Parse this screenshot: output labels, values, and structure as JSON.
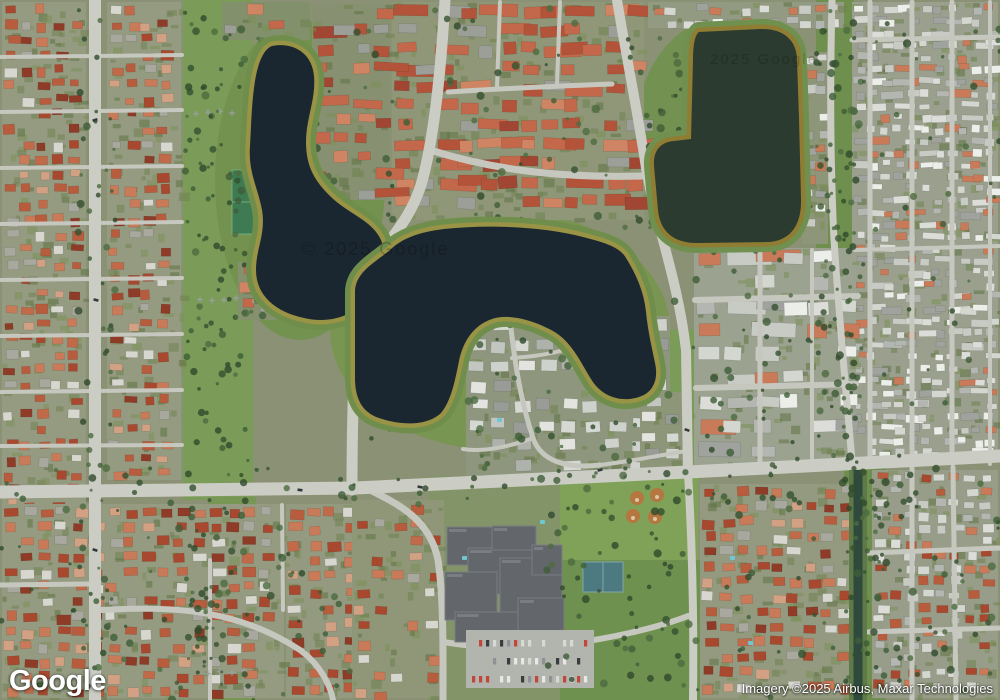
{
  "branding": {
    "logo": "Google"
  },
  "attribution": {
    "text": "Imagery ©2025 Airbus, Maxar Technologies"
  },
  "watermarks": [
    {
      "text": "© 2025 Google",
      "x": 302,
      "y": 255,
      "size": 18,
      "opacity": 0.22
    },
    {
      "text": "2025 Google",
      "x": 710,
      "y": 64,
      "size": 15,
      "opacity": 0.18
    }
  ],
  "map": {
    "colors": {
      "base": "#8b9174",
      "road_major": "#cbccc4",
      "road_minor": "#c6c8bf",
      "lawn": [
        "#6f8250",
        "#7b8f58",
        "#5e7344"
      ],
      "tree": [
        "#3f5e38",
        "#4c6c40",
        "#35512f",
        "#2f4a2c"
      ],
      "car": [
        "#e8e8e6",
        "#3a3d40",
        "#8f9294",
        "#c2473a",
        "#d8d8d4"
      ]
    },
    "palettes": {
      "redMix": [
        "#a8492f",
        "#b85c3e",
        "#c97a58",
        "#8e3b28",
        "#c06a4a",
        "#d8d7cf",
        "#a8a89f",
        "#b85c3e",
        "#a8492f",
        "#c97a58",
        "#d2a184"
      ],
      "condoRed": [
        "#b3543a",
        "#c3684a",
        "#a04632",
        "#cf8563",
        "#b3543a",
        "#c3684a",
        "#9c9f98"
      ],
      "whiteMix": [
        "#dcddd8",
        "#c8cac4",
        "#eceeea",
        "#b4b7b1",
        "#d4d6d0",
        "#9fa29d",
        "#c97a58"
      ],
      "grayTown": [
        "#c2c5c0",
        "#d6d8d3",
        "#aeb1ac",
        "#e3e4e0",
        "#989b96",
        "#cfd1cc"
      ],
      "mixed": [
        "#dcddd8",
        "#b85c3e",
        "#c8cac4",
        "#a8492f",
        "#d4d6d0",
        "#c97a58",
        "#b4b7b1"
      ]
    },
    "green_zones": [
      {
        "type": "rect",
        "x": 183,
        "y": 0,
        "w": 70,
        "h": 500,
        "fill": "#7b9b58"
      },
      {
        "type": "rect",
        "x": 208,
        "y": 497,
        "w": 48,
        "h": 203,
        "fill": "#789755"
      },
      {
        "type": "ellipse",
        "cx": 300,
        "cy": 180,
        "rx": 85,
        "ry": 160,
        "fill": "#74924f"
      },
      {
        "type": "ellipse",
        "cx": 500,
        "cy": 330,
        "rx": 170,
        "ry": 120,
        "fill": "#789551"
      },
      {
        "type": "ellipse",
        "cx": 730,
        "cy": 135,
        "rx": 95,
        "ry": 120,
        "fill": "#739150"
      },
      {
        "type": "rect",
        "x": 640,
        "y": 330,
        "w": 60,
        "h": 150,
        "fill": "#7b9b58"
      },
      {
        "type": "rect",
        "x": 816,
        "y": 0,
        "w": 38,
        "h": 468,
        "fill": "#6f8f4e"
      },
      {
        "type": "rect",
        "x": 844,
        "y": 468,
        "w": 42,
        "h": 232,
        "fill": "#6f8f4e"
      },
      {
        "type": "rect",
        "x": 540,
        "y": 474,
        "w": 158,
        "h": 110,
        "fill": "#7fa258"
      },
      {
        "type": "rect",
        "x": 560,
        "y": 560,
        "w": 140,
        "h": 140,
        "fill": "#6f9150"
      },
      {
        "type": "rect",
        "x": 428,
        "y": 476,
        "w": 132,
        "h": 224,
        "fill": "#839468"
      },
      {
        "type": "rect",
        "x": 91,
        "y": 8,
        "w": 4,
        "h": 80,
        "fill": "#688a47"
      },
      {
        "type": "rect",
        "x": 91,
        "y": 128,
        "w": 4,
        "h": 170,
        "fill": "#688a47"
      },
      {
        "type": "rect",
        "x": 91,
        "y": 330,
        "w": 4,
        "h": 125,
        "fill": "#688a47"
      },
      {
        "type": "rect",
        "x": 93,
        "y": 525,
        "w": 4,
        "h": 175,
        "fill": "#688a47"
      }
    ],
    "regions": [
      {
        "name": "left-west",
        "x": 2,
        "y": 2,
        "w": 84,
        "h": 694,
        "sx": 16,
        "sy": 15,
        "hw": [
          8,
          13
        ],
        "hh": [
          6,
          10
        ],
        "skip": 0.22,
        "palette": "redMix",
        "ground": "#949b81"
      },
      {
        "name": "left-mid",
        "x": 107,
        "y": 2,
        "w": 74,
        "h": 478,
        "sx": 16,
        "sy": 15,
        "hw": [
          8,
          13
        ],
        "hh": [
          6,
          10
        ],
        "skip": 0.2,
        "palette": "redMix",
        "ground": "#949b81"
      },
      {
        "name": "top-center",
        "x": 392,
        "y": 2,
        "w": 252,
        "h": 218,
        "sx": 21,
        "sy": 19,
        "hw": [
          12,
          19
        ],
        "hh": [
          9,
          13
        ],
        "skip": 0.25,
        "palette": "condoRed",
        "ground": "#8f9778",
        "strip": true
      },
      {
        "name": "lakeA-east",
        "x": 312,
        "y": 4,
        "w": 78,
        "h": 196,
        "sx": 20,
        "sy": 18,
        "hw": [
          11,
          17
        ],
        "hh": [
          8,
          12
        ],
        "skip": 0.3,
        "palette": "condoRed",
        "ground": "#879070",
        "strip": true
      },
      {
        "name": "lakeA-top",
        "x": 222,
        "y": 2,
        "w": 88,
        "h": 38,
        "sx": 20,
        "sy": 17,
        "hw": [
          11,
          16
        ],
        "hh": [
          8,
          12
        ],
        "skip": 0.3,
        "palette": "condoRed",
        "ground": "#82906c"
      },
      {
        "name": "lakeA-south",
        "x": 238,
        "y": 262,
        "w": 118,
        "h": 58,
        "sx": 19,
        "sy": 17,
        "hw": [
          10,
          16
        ],
        "hh": [
          8,
          11
        ],
        "skip": 0.3,
        "palette": "condoRed",
        "ground": "#85916e",
        "strip": true
      },
      {
        "name": "right-top-grid",
        "x": 852,
        "y": 2,
        "w": 146,
        "h": 458,
        "sx": 13,
        "sy": 12,
        "hw": [
          7,
          11
        ],
        "hh": [
          5,
          8
        ],
        "skip": 0.2,
        "palette": "whiteMix",
        "ground": "#9aa08d",
        "strip": true
      },
      {
        "name": "lakeC-east-col",
        "x": 802,
        "y": 52,
        "w": 26,
        "h": 192,
        "sx": 12,
        "sy": 15,
        "hw": [
          8,
          11
        ],
        "hh": [
          6,
          9
        ],
        "skip": 0.25,
        "palette": "whiteMix",
        "ground": "#8d9678"
      },
      {
        "name": "lakeC-north",
        "x": 648,
        "y": 2,
        "w": 196,
        "h": 26,
        "sx": 15,
        "sy": 13,
        "hw": [
          8,
          12
        ],
        "hh": [
          6,
          9
        ],
        "skip": 0.25,
        "palette": "whiteMix",
        "ground": "#939a82"
      },
      {
        "name": "mid-right",
        "x": 694,
        "y": 248,
        "w": 162,
        "h": 218,
        "sx": 28,
        "sy": 24,
        "hw": [
          16,
          24
        ],
        "hh": [
          10,
          15
        ],
        "skip": 0.3,
        "palette": "whiteMix",
        "ground": "#9ba290",
        "strip": true
      },
      {
        "name": "peninsula",
        "x": 466,
        "y": 316,
        "w": 204,
        "h": 160,
        "sx": 23,
        "sy": 20,
        "hw": [
          13,
          18
        ],
        "hh": [
          9,
          12
        ],
        "skip": 0.25,
        "palette": "grayTown",
        "ground": "#8e977d"
      },
      {
        "name": "east-road-row",
        "x": 640,
        "y": 392,
        "w": 52,
        "h": 78,
        "sx": 20,
        "sy": 18,
        "hw": [
          11,
          15
        ],
        "hh": [
          8,
          11
        ],
        "skip": 0.3,
        "palette": "grayTown",
        "ground": "#8d9678"
      },
      {
        "name": "south-center",
        "x": 286,
        "y": 504,
        "w": 118,
        "h": 194,
        "sx": 18,
        "sy": 16,
        "hw": [
          9,
          14
        ],
        "hh": [
          7,
          10
        ],
        "skip": 0.25,
        "palette": "redMix",
        "ground": "#939a80"
      },
      {
        "name": "school-west",
        "x": 352,
        "y": 500,
        "w": 92,
        "h": 198,
        "sx": 18,
        "sy": 17,
        "hw": [
          9,
          13
        ],
        "hh": [
          7,
          10
        ],
        "skip": 0.45,
        "palette": "redMix",
        "ground": "#8f9778"
      },
      {
        "name": "bottom-left",
        "x": 2,
        "y": 504,
        "w": 282,
        "h": 194,
        "sx": 17,
        "sy": 15,
        "hw": [
          9,
          14
        ],
        "hh": [
          7,
          10
        ],
        "skip": 0.22,
        "palette": "redMix",
        "ground": "#949b81"
      },
      {
        "name": "se-west-canal",
        "x": 700,
        "y": 484,
        "w": 150,
        "h": 214,
        "sx": 17,
        "sy": 15,
        "hw": [
          9,
          14
        ],
        "hh": [
          7,
          10
        ],
        "skip": 0.22,
        "palette": "redMix",
        "ground": "#939a80"
      },
      {
        "name": "se-east-canal",
        "x": 872,
        "y": 470,
        "w": 126,
        "h": 228,
        "sx": 15,
        "sy": 13,
        "hw": [
          8,
          12
        ],
        "hh": [
          6,
          9
        ],
        "skip": 0.22,
        "palette": "mixed",
        "ground": "#979d88"
      }
    ],
    "roads_minor": [
      {
        "d": "M430,150 C500,172 570,178 642,176",
        "w": 7
      },
      {
        "d": "M368,292 C330,304 292,309 255,301",
        "w": 5
      },
      {
        "d": "M448,92 C510,88 560,86 612,84",
        "w": 5
      },
      {
        "d": "M500,2 L497,88",
        "w": 4
      },
      {
        "d": "M560,2 L557,85",
        "w": 4
      },
      {
        "d": "M0,57 L182,55",
        "w": 4
      },
      {
        "d": "M0,112 L182,110",
        "w": 4
      },
      {
        "d": "M0,168 L182,166",
        "w": 4
      },
      {
        "d": "M0,224 L182,222",
        "w": 4
      },
      {
        "d": "M0,280 L182,278",
        "w": 4
      },
      {
        "d": "M0,336 L182,334",
        "w": 4
      },
      {
        "d": "M0,392 L182,390",
        "w": 4
      },
      {
        "d": "M0,446 L182,445",
        "w": 4
      },
      {
        "d": "M870,2 L870,460",
        "w": 5
      },
      {
        "d": "M912,2 L912,462",
        "w": 5
      },
      {
        "d": "M952,2 L952,463",
        "w": 5
      },
      {
        "d": "M990,2 L990,464",
        "w": 4
      },
      {
        "d": "M852,40 L1000,37",
        "w": 5
      },
      {
        "d": "M855,250 L1000,246",
        "w": 4
      },
      {
        "d": "M912,468 L912,700",
        "w": 5
      },
      {
        "d": "M953,467 L956,700",
        "w": 5
      },
      {
        "d": "M868,553 L1000,548",
        "w": 5
      },
      {
        "d": "M866,632 L1000,628",
        "w": 5
      },
      {
        "d": "M695,300 L858,296",
        "w": 6
      },
      {
        "d": "M696,388 L856,384",
        "w": 6
      },
      {
        "d": "M760,250 L760,465",
        "w": 5
      },
      {
        "d": "M812,250 L812,462",
        "w": 4
      },
      {
        "d": "M510,320 C515,365 521,402 533,438 C541,461 566,469 600,465",
        "w": 5
      },
      {
        "d": "M533,438 C506,448 481,452 463,449",
        "w": 4
      },
      {
        "d": "M600,465 C634,461 660,455 687,451",
        "w": 4
      },
      {
        "d": "M512,358 C545,356 570,350 588,341",
        "w": 4
      },
      {
        "d": "M370,490 C400,505 430,520 438,560 C444,600 443,660 443,700",
        "w": 7
      },
      {
        "d": "M443,642 C480,648 520,650 560,645 C610,639 660,627 688,616",
        "w": 6
      },
      {
        "d": "M102,610 C180,605 242,612 300,650 C322,666 331,688 333,700",
        "w": 6
      },
      {
        "d": "M0,585 L88,584",
        "w": 5
      },
      {
        "d": "M210,560 L210,700",
        "w": 4
      },
      {
        "d": "M282,505 L283,610",
        "w": 4
      }
    ],
    "roads_major": [
      {
        "d": "M0,492 L355,488 L688,472 L1000,456",
        "w": 13
      },
      {
        "d": "M95,0 L95,700",
        "w": 12
      },
      {
        "d": "M445,0 C441,70 434,140 421,185 C405,235 372,250 361,295 C354,340 352,420 352,490",
        "w": 11
      },
      {
        "d": "M617,0 C627,60 639,120 646,168 C656,225 678,280 686,350 L688,473",
        "w": 10
      },
      {
        "d": "M688,473 C692,540 694,620 693,700",
        "w": 8
      },
      {
        "d": "M832,0 C830,80 830,160 834,240 C840,330 847,400 852,462",
        "w": 7
      }
    ],
    "road_cars": [
      [
        600,
        470
      ],
      [
        300,
        490
      ],
      [
        96,
        300
      ],
      [
        687,
        430
      ],
      [
        95,
        550
      ],
      [
        420,
        487
      ],
      [
        650,
        175
      ],
      [
        95,
        120
      ]
    ],
    "landmarks": {
      "school_buildings": [
        [
          447,
          527,
          58,
          38
        ],
        [
          468,
          548,
          72,
          46
        ],
        [
          445,
          572,
          52,
          48
        ],
        [
          500,
          558,
          62,
          56
        ],
        [
          455,
          612,
          72,
          30
        ],
        [
          518,
          598,
          46,
          40
        ],
        [
          492,
          526,
          44,
          24
        ],
        [
          532,
          545,
          30,
          30
        ]
      ],
      "school_fill": "#63666a",
      "school_accent": "#7a7e82",
      "parking": {
        "x": 466,
        "y": 630,
        "w": 128,
        "h": 58,
        "fill": "#b2b4ae"
      },
      "courts": {
        "x": 583,
        "y": 562,
        "w": 40,
        "h": 30,
        "fill": "#4d7a80",
        "line": "#7fa5a8"
      },
      "tennis": {
        "x": 232,
        "y": 170,
        "w": 22,
        "h": 64,
        "fill": "#3e7a52",
        "line": "#6fae7e"
      },
      "baseball": {
        "fill": "#b5763f",
        "spots": [
          [
            637,
            498
          ],
          [
            657,
            495
          ],
          [
            633,
            516
          ],
          [
            655,
            517
          ]
        ]
      },
      "canal": {
        "d": "M858,470 L858,700",
        "w": 9,
        "water": "#2f4a3c",
        "bank": "#5d7a48",
        "bankW": 18
      },
      "tower_rows": [
        {
          "x0": 196,
          "y0": 112,
          "dx": 12,
          "n": 4
        },
        {
          "x0": 200,
          "y0": 300,
          "dx": 12,
          "n": 4
        },
        {
          "x0": 208,
          "y0": 672,
          "dx": 12,
          "n": 4
        }
      ],
      "pools": [
        [
          493,
          306
        ],
        [
          497,
          418
        ],
        [
          462,
          556
        ],
        [
          730,
          556
        ],
        [
          748,
          641
        ],
        [
          540,
          520
        ]
      ]
    },
    "tree_clusters": [
      {
        "x": 185,
        "y": 0,
        "w": 64,
        "h": 700,
        "n": 140
      },
      {
        "x": 235,
        "y": 25,
        "w": 160,
        "h": 310,
        "n": 60
      },
      {
        "x": 345,
        "y": 215,
        "w": 320,
        "h": 230,
        "n": 70
      },
      {
        "x": 645,
        "y": 20,
        "w": 170,
        "h": 235,
        "n": 50
      },
      {
        "x": 816,
        "y": 0,
        "w": 46,
        "h": 470,
        "n": 85
      },
      {
        "x": 545,
        "y": 480,
        "w": 155,
        "h": 215,
        "n": 60
      },
      {
        "x": 0,
        "y": 468,
        "w": 1000,
        "h": 44,
        "n": 65
      },
      {
        "x": 78,
        "y": 0,
        "w": 40,
        "h": 700,
        "n": 55
      },
      {
        "x": 845,
        "y": 468,
        "w": 42,
        "h": 232,
        "n": 45
      },
      {
        "x": 460,
        "y": 300,
        "w": 215,
        "h": 180,
        "n": 40
      },
      {
        "x": 690,
        "y": 248,
        "w": 170,
        "h": 220,
        "n": 45
      },
      {
        "x": 0,
        "y": 500,
        "w": 350,
        "h": 200,
        "n": 70
      },
      {
        "x": 390,
        "y": 0,
        "w": 260,
        "h": 230,
        "n": 50
      },
      {
        "x": 852,
        "y": 0,
        "w": 148,
        "h": 460,
        "n": 40
      },
      {
        "x": 700,
        "y": 480,
        "w": 300,
        "h": 220,
        "n": 60
      }
    ],
    "lakes": [
      {
        "name": "lake-west",
        "d": "M272,46 C292,42 312,52 314,76 C316,100 306,118 306,142 C306,168 316,182 330,196 C348,214 372,220 381,240 C390,262 376,282 368,296 C356,316 330,324 304,318 C276,312 256,296 256,270 C256,248 266,234 262,210 C258,188 248,172 250,146 C252,112 252,54 272,46 Z",
        "water": "#1b2730",
        "shore": "#999346",
        "outer": "#6f8e4b"
      },
      {
        "name": "lake-center",
        "d": "M390,250 C402,238 420,232 444,229 C492,224 545,227 583,237 C603,242 620,247 626,258 C636,274 644,292 646,312 C648,332 652,348 655,363 C659,381 652,393 639,397 C620,403 601,396 591,379 C580,361 571,341 553,331 C535,321 510,313 492,319 C474,325 463,341 459,361 C455,381 451,401 441,413 C426,427 399,425 379,418 C361,412 355,397 355,378 L355,292 C355,272 376,262 390,250 Z",
        "water": "#1b2730",
        "shore": "#999346",
        "outer": "#6f8e4b"
      },
      {
        "name": "lake-east",
        "d": "M699,32 L760,29 C783,28 797,40 797,60 L799,118 L801,198 C802,224 791,241 768,242 L697,243 C673,243 660,231 658,210 L654,166 C653,150 661,142 674,141 L691,139 L693,60 C693,44 695,35 699,32 Z",
        "water": "#2b3b2f",
        "shore": "#8f7d33",
        "outer": "#709050"
      }
    ]
  }
}
